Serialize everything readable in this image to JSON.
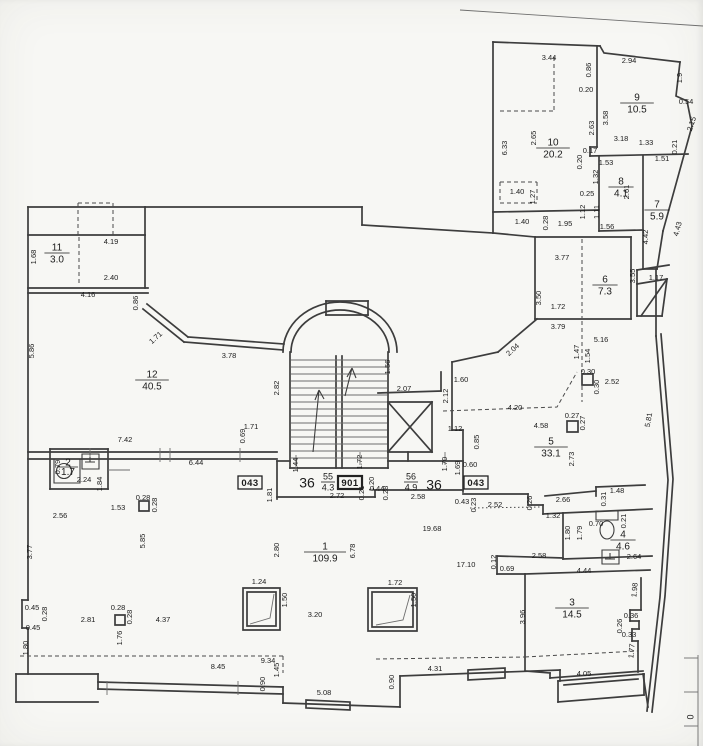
{
  "document": {
    "kind": "floor-plan-scan"
  },
  "rooms": [
    {
      "number": "1",
      "area": "109.9",
      "x": 325,
      "y": 552
    },
    {
      "number": "2",
      "area": "1.7",
      "x": 68,
      "y": 467,
      "small": true
    },
    {
      "number": "3",
      "area": "14.5",
      "x": 572,
      "y": 608
    },
    {
      "number": "4",
      "area": "4.6",
      "x": 623,
      "y": 540
    },
    {
      "number": "5",
      "area": "33.1",
      "x": 551,
      "y": 447
    },
    {
      "number": "6",
      "area": "7.3",
      "x": 605,
      "y": 285
    },
    {
      "number": "7",
      "area": "5.9",
      "x": 657,
      "y": 210
    },
    {
      "number": "8",
      "area": "4.1",
      "x": 621,
      "y": 187
    },
    {
      "number": "9",
      "area": "10.5",
      "x": 637,
      "y": 103
    },
    {
      "number": "10",
      "area": "20.2",
      "x": 553,
      "y": 148
    },
    {
      "number": "11",
      "area": "3.0",
      "x": 57,
      "y": 253
    },
    {
      "number": "12",
      "area": "40.5",
      "x": 152,
      "y": 380
    }
  ],
  "corridor_numbers": [
    {
      "t": "36",
      "x": 307,
      "y": 484
    },
    {
      "t": "36",
      "x": 434,
      "y": 486
    }
  ],
  "fractions": [
    {
      "top": "55",
      "bottom": "4.3",
      "x": 328,
      "y": 482
    },
    {
      "top": "56",
      "bottom": "4.9",
      "x": 411,
      "y": 482
    }
  ],
  "badges": [
    {
      "t": "043",
      "x": 250,
      "y": 483
    },
    {
      "t": "901",
      "x": 350,
      "y": 483,
      "bold": true
    },
    {
      "t": "043",
      "x": 476,
      "y": 483
    }
  ],
  "edge_marks": [
    {
      "t": "0",
      "x": 691,
      "y": 717,
      "r": -90
    }
  ],
  "dimensions": [
    {
      "t": "3.44",
      "x": 549,
      "y": 58
    },
    {
      "t": "0.86",
      "x": 589,
      "y": 70,
      "r": -90
    },
    {
      "t": "0.20",
      "x": 586,
      "y": 90
    },
    {
      "t": "2.63",
      "x": 592,
      "y": 128,
      "r": -90
    },
    {
      "t": "3.58",
      "x": 606,
      "y": 118,
      "r": -90
    },
    {
      "t": "2.94",
      "x": 629,
      "y": 61
    },
    {
      "t": "1.9",
      "x": 680,
      "y": 78,
      "r": -90
    },
    {
      "t": "0.54",
      "x": 686,
      "y": 102
    },
    {
      "t": "2.15",
      "x": 692,
      "y": 124,
      "r": -72
    },
    {
      "t": "6.33",
      "x": 505,
      "y": 148,
      "r": -90
    },
    {
      "t": "2.65",
      "x": 534,
      "y": 138,
      "r": -90
    },
    {
      "t": "3.18",
      "x": 621,
      "y": 139
    },
    {
      "t": "1.33",
      "x": 646,
      "y": 143
    },
    {
      "t": "0.21",
      "x": 675,
      "y": 147,
      "r": -90
    },
    {
      "t": "0.17",
      "x": 590,
      "y": 151
    },
    {
      "t": "0.20",
      "x": 580,
      "y": 162,
      "r": -90
    },
    {
      "t": "1.53",
      "x": 606,
      "y": 163
    },
    {
      "t": "1.51",
      "x": 662,
      "y": 159
    },
    {
      "t": "1.32",
      "x": 596,
      "y": 177,
      "r": -90
    },
    {
      "t": "0.25",
      "x": 587,
      "y": 194
    },
    {
      "t": "1.12",
      "x": 583,
      "y": 212,
      "r": -90
    },
    {
      "t": "1.11",
      "x": 597,
      "y": 212,
      "r": -90
    },
    {
      "t": "1.56",
      "x": 607,
      "y": 227
    },
    {
      "t": "2.61",
      "x": 627,
      "y": 192,
      "r": -90
    },
    {
      "t": "4.43",
      "x": 678,
      "y": 229,
      "r": -75
    },
    {
      "t": "4.42",
      "x": 646,
      "y": 237,
      "r": -90
    },
    {
      "t": "1.40",
      "x": 517,
      "y": 192
    },
    {
      "t": "1.27",
      "x": 533,
      "y": 197,
      "r": -90
    },
    {
      "t": "1.40",
      "x": 522,
      "y": 222
    },
    {
      "t": "0.28",
      "x": 546,
      "y": 223,
      "r": -90
    },
    {
      "t": "1.95",
      "x": 565,
      "y": 224
    },
    {
      "t": "3.77",
      "x": 562,
      "y": 258
    },
    {
      "t": "3.50",
      "x": 539,
      "y": 298,
      "r": -90
    },
    {
      "t": "3.55",
      "x": 633,
      "y": 276,
      "r": -90
    },
    {
      "t": "1.17",
      "x": 656,
      "y": 278
    },
    {
      "t": "1.72",
      "x": 558,
      "y": 307
    },
    {
      "t": "3.79",
      "x": 558,
      "y": 327
    },
    {
      "t": "5.16",
      "x": 601,
      "y": 340
    },
    {
      "t": "1.47",
      "x": 577,
      "y": 352,
      "r": -90
    },
    {
      "t": "1.54",
      "x": 588,
      "y": 356,
      "r": -90
    },
    {
      "t": "1.68",
      "x": 34,
      "y": 257,
      "r": -90
    },
    {
      "t": "4.19",
      "x": 111,
      "y": 242
    },
    {
      "t": "2.40",
      "x": 111,
      "y": 278
    },
    {
      "t": "4.16",
      "x": 88,
      "y": 295
    },
    {
      "t": "0.86",
      "x": 136,
      "y": 303,
      "r": -90
    },
    {
      "t": "5.86",
      "x": 32,
      "y": 351,
      "r": -90
    },
    {
      "t": "1.71",
      "x": 156,
      "y": 338,
      "r": -42
    },
    {
      "t": "3.78",
      "x": 229,
      "y": 356
    },
    {
      "t": "2.82",
      "x": 277,
      "y": 388,
      "r": -90
    },
    {
      "t": "1.71",
      "x": 251,
      "y": 427
    },
    {
      "t": "0.69",
      "x": 243,
      "y": 436,
      "r": -90
    },
    {
      "t": "7.42",
      "x": 125,
      "y": 440
    },
    {
      "t": "6.44",
      "x": 196,
      "y": 463
    },
    {
      "t": "2.56",
      "x": 60,
      "y": 516
    },
    {
      "t": "1.53",
      "x": 118,
      "y": 508
    },
    {
      "t": "0.28",
      "x": 143,
      "y": 498
    },
    {
      "t": "0.28",
      "x": 155,
      "y": 505,
      "r": -90
    },
    {
      "t": "5.85",
      "x": 143,
      "y": 541,
      "r": -90
    },
    {
      "t": "3.77",
      "x": 30,
      "y": 552,
      "r": -90
    },
    {
      "t": "0.79",
      "x": 58,
      "y": 467,
      "r": -90
    },
    {
      "t": "2.24",
      "x": 84,
      "y": 480
    },
    {
      "t": "1.84",
      "x": 100,
      "y": 484,
      "r": -90
    },
    {
      "t": "1.56",
      "x": 388,
      "y": 367,
      "r": -90
    },
    {
      "t": "2.07",
      "x": 404,
      "y": 389
    },
    {
      "t": "2.12",
      "x": 446,
      "y": 396,
      "r": -90
    },
    {
      "t": "1.60",
      "x": 461,
      "y": 380
    },
    {
      "t": "2.04",
      "x": 513,
      "y": 350,
      "r": -42
    },
    {
      "t": "1.44",
      "x": 296,
      "y": 465,
      "r": -90
    },
    {
      "t": "1.72",
      "x": 360,
      "y": 462,
      "r": -90
    },
    {
      "t": "1.20",
      "x": 372,
      "y": 484,
      "r": -90
    },
    {
      "t": "0.21",
      "x": 362,
      "y": 493,
      "r": -90
    },
    {
      "t": "0.44",
      "x": 377,
      "y": 489
    },
    {
      "t": "0.28",
      "x": 386,
      "y": 493,
      "r": -90
    },
    {
      "t": "2.72",
      "x": 337,
      "y": 496
    },
    {
      "t": "2.58",
      "x": 418,
      "y": 497
    },
    {
      "t": "1.81",
      "x": 270,
      "y": 495,
      "r": -90
    },
    {
      "t": "1.70",
      "x": 445,
      "y": 464,
      "r": -90
    },
    {
      "t": "1.69",
      "x": 458,
      "y": 468,
      "r": -90
    },
    {
      "t": "0.60",
      "x": 470,
      "y": 465
    },
    {
      "t": "0.43",
      "x": 462,
      "y": 502
    },
    {
      "t": "0.23",
      "x": 474,
      "y": 505,
      "r": -90
    },
    {
      "t": "2.52",
      "x": 495,
      "y": 505
    },
    {
      "t": "0.26",
      "x": 530,
      "y": 503,
      "r": -90
    },
    {
      "t": "19.68",
      "x": 432,
      "y": 529
    },
    {
      "t": "4.20",
      "x": 515,
      "y": 408
    },
    {
      "t": "0.30",
      "x": 588,
      "y": 372
    },
    {
      "t": "0.30",
      "x": 597,
      "y": 387,
      "r": -90
    },
    {
      "t": "2.52",
      "x": 612,
      "y": 382
    },
    {
      "t": "0.27",
      "x": 572,
      "y": 416
    },
    {
      "t": "0.27",
      "x": 583,
      "y": 423,
      "r": -90
    },
    {
      "t": "4.58",
      "x": 541,
      "y": 426
    },
    {
      "t": "2.73",
      "x": 572,
      "y": 459,
      "r": -90
    },
    {
      "t": "5.81",
      "x": 649,
      "y": 420,
      "r": -80
    },
    {
      "t": "1.12",
      "x": 455,
      "y": 429
    },
    {
      "t": "0.85",
      "x": 477,
      "y": 442,
      "r": -90
    },
    {
      "t": "1.48",
      "x": 617,
      "y": 491
    },
    {
      "t": "0.31",
      "x": 604,
      "y": 499,
      "r": -90
    },
    {
      "t": "2.66",
      "x": 563,
      "y": 500
    },
    {
      "t": "1.32",
      "x": 553,
      "y": 516
    },
    {
      "t": "1.80",
      "x": 568,
      "y": 533,
      "r": -90
    },
    {
      "t": "1.79",
      "x": 580,
      "y": 533,
      "r": -90
    },
    {
      "t": "0.70",
      "x": 596,
      "y": 524
    },
    {
      "t": "0.21",
      "x": 624,
      "y": 521,
      "r": -90
    },
    {
      "t": "2.64",
      "x": 634,
      "y": 557
    },
    {
      "t": "4.44",
      "x": 584,
      "y": 571
    },
    {
      "t": "2.58",
      "x": 539,
      "y": 556
    },
    {
      "t": "0.12",
      "x": 494,
      "y": 562,
      "r": -90
    },
    {
      "t": "0.69",
      "x": 507,
      "y": 569
    },
    {
      "t": "17.10",
      "x": 466,
      "y": 565
    },
    {
      "t": "3.96",
      "x": 523,
      "y": 617,
      "r": -90
    },
    {
      "t": "1.98",
      "x": 635,
      "y": 590,
      "r": -84
    },
    {
      "t": "0.36",
      "x": 631,
      "y": 616
    },
    {
      "t": "0.26",
      "x": 620,
      "y": 626,
      "r": -90
    },
    {
      "t": "0.33",
      "x": 629,
      "y": 635
    },
    {
      "t": "1.77",
      "x": 632,
      "y": 651,
      "r": -84
    },
    {
      "t": "4.05",
      "x": 584,
      "y": 674
    },
    {
      "t": "2.80",
      "x": 277,
      "y": 550,
      "r": -90
    },
    {
      "t": "6.78",
      "x": 353,
      "y": 551,
      "r": -90
    },
    {
      "t": "1.24",
      "x": 259,
      "y": 582
    },
    {
      "t": "1.50",
      "x": 285,
      "y": 600,
      "r": -90
    },
    {
      "t": "3.20",
      "x": 315,
      "y": 615
    },
    {
      "t": "1.72",
      "x": 395,
      "y": 583
    },
    {
      "t": "1.50",
      "x": 414,
      "y": 600,
      "r": -90
    },
    {
      "t": "0.45",
      "x": 32,
      "y": 608
    },
    {
      "t": "0.28",
      "x": 45,
      "y": 614,
      "r": -90
    },
    {
      "t": "0.45",
      "x": 33,
      "y": 628
    },
    {
      "t": "2.81",
      "x": 88,
      "y": 620
    },
    {
      "t": "0.28",
      "x": 118,
      "y": 608
    },
    {
      "t": "0.28",
      "x": 130,
      "y": 617,
      "r": -90
    },
    {
      "t": "4.37",
      "x": 163,
      "y": 620
    },
    {
      "t": "1.76",
      "x": 120,
      "y": 638,
      "r": -90
    },
    {
      "t": "1.80",
      "x": 26,
      "y": 648,
      "r": -90
    },
    {
      "t": "8.45",
      "x": 218,
      "y": 667
    },
    {
      "t": "9.34",
      "x": 268,
      "y": 661
    },
    {
      "t": "1.45",
      "x": 277,
      "y": 670,
      "r": -90
    },
    {
      "t": "0.90",
      "x": 263,
      "y": 684,
      "r": -90
    },
    {
      "t": "5.08",
      "x": 324,
      "y": 693
    },
    {
      "t": "0.90",
      "x": 392,
      "y": 682,
      "r": -90
    },
    {
      "t": "4.31",
      "x": 435,
      "y": 669
    }
  ]
}
